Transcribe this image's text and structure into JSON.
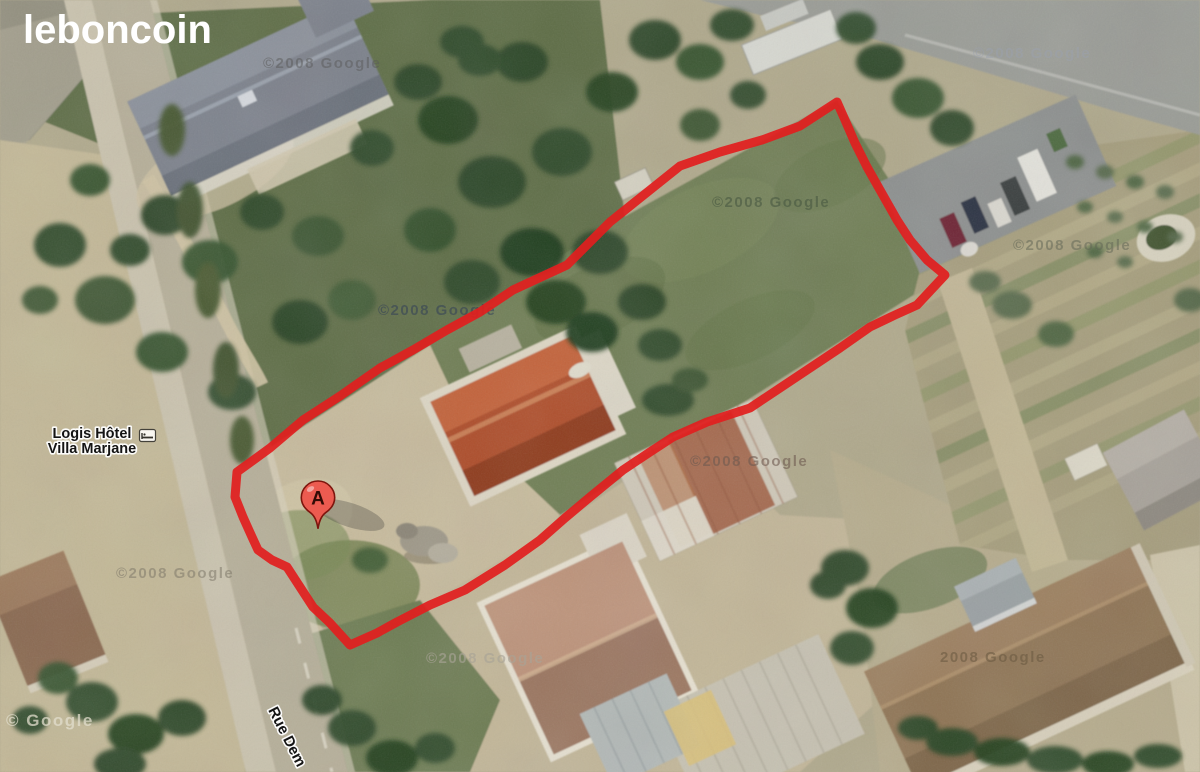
{
  "branding": {
    "logo_text": "leboncoin"
  },
  "colors": {
    "parcel_outline": "#e11f1f",
    "marker_fill": "#ec5b50",
    "marker_border": "#7d150d"
  },
  "map": {
    "poi_label": {
      "line1": "Logis Hôtel",
      "line2": "Villa Marjane",
      "icon": "lodging-bed-icon"
    },
    "street_label": "Rue Dem",
    "marker": {
      "letter": "A"
    },
    "parcel_outline_points": "837,102 800,126 762,140 720,152 680,166 640,198 610,222 567,265 513,290 480,312 447,330 413,350 380,368 340,396 303,420 270,448 237,472 235,497 243,517 252,537 258,550 272,560 287,567 300,587 313,607 330,623 350,645 377,633 397,622 430,605 465,590 505,565 540,540 565,518 590,497 623,470 650,452 673,437 707,422 750,408 780,388 810,368 840,348 870,327 895,315 917,305 945,275 927,260 910,240 897,220 880,190 867,167 855,143 845,120",
    "watermarks": [
      {
        "text": "©2008 Google"
      },
      {
        "text": "©2008 Google"
      },
      {
        "text": "©2008 Google"
      },
      {
        "text": "©2008 Google"
      },
      {
        "text": "©2008 Google"
      },
      {
        "text": "©2008 Google"
      },
      {
        "text": "©2008 Google"
      },
      {
        "text": "©2008 Google"
      },
      {
        "text": "2008 Google"
      },
      {
        "text": "© Google"
      }
    ]
  }
}
